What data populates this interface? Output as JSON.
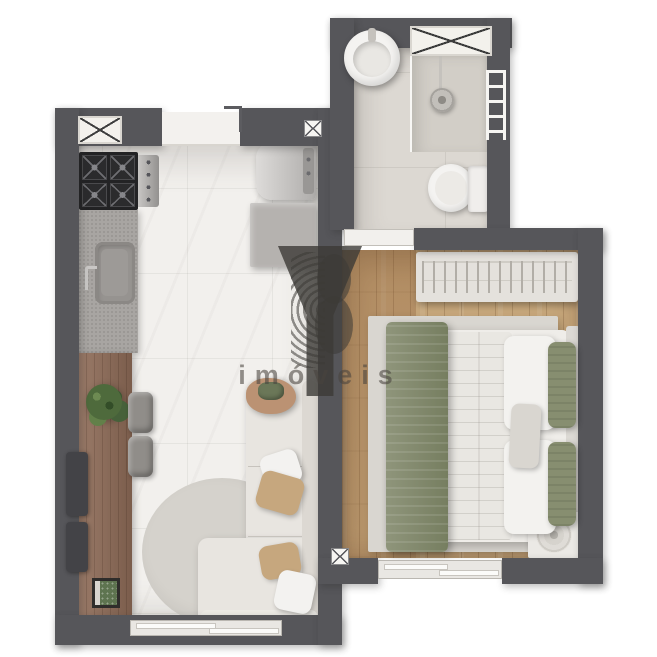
{
  "watermark": {
    "brand": "YBY",
    "subtitle": "imóveis"
  },
  "palette": {
    "bg": "#ffffff",
    "wall": "#56565a",
    "marble": "#f2f0ed",
    "bathfloor": "#dcd8d2",
    "showerfloor": "#d2cec7",
    "woodfloor": "#c8a87c",
    "wooddark": "#8f6c58",
    "countergray": "#a8a5a2",
    "stove": "#232325",
    "fixture": "#f4f3f1",
    "sofa": "#e8e5e0",
    "sofaback": "#dcd8d2",
    "ruground": "#d5d2cc",
    "rugbed": "#d9d6d0",
    "bedwhite": "#efede9",
    "olive": "#878e70",
    "tan": "#c6a77e",
    "plant": "#4e6a3c",
    "ink": "rgba(60,58,54,0.55)",
    "inktext": "rgba(72,68,62,0.58)"
  },
  "floorplan": {
    "rooms": [
      "kitchen-living-room",
      "bathroom",
      "bedroom"
    ],
    "fixtures": [
      "entry-door",
      "gas-cooktop",
      "kitchen-sink",
      "refrigerator",
      "kitchen-cabinet",
      "wood-counter",
      "counter-stools",
      "plant",
      "book",
      "round-rug",
      "l-shaped-sofa",
      "side-table",
      "bathroom-sink",
      "shower",
      "toilet",
      "towel-rack",
      "bathroom-door",
      "wardrobe-rack",
      "double-bed",
      "nightstand",
      "table-lamp",
      "bedroom-rug",
      "windows",
      "ac-units"
    ]
  }
}
